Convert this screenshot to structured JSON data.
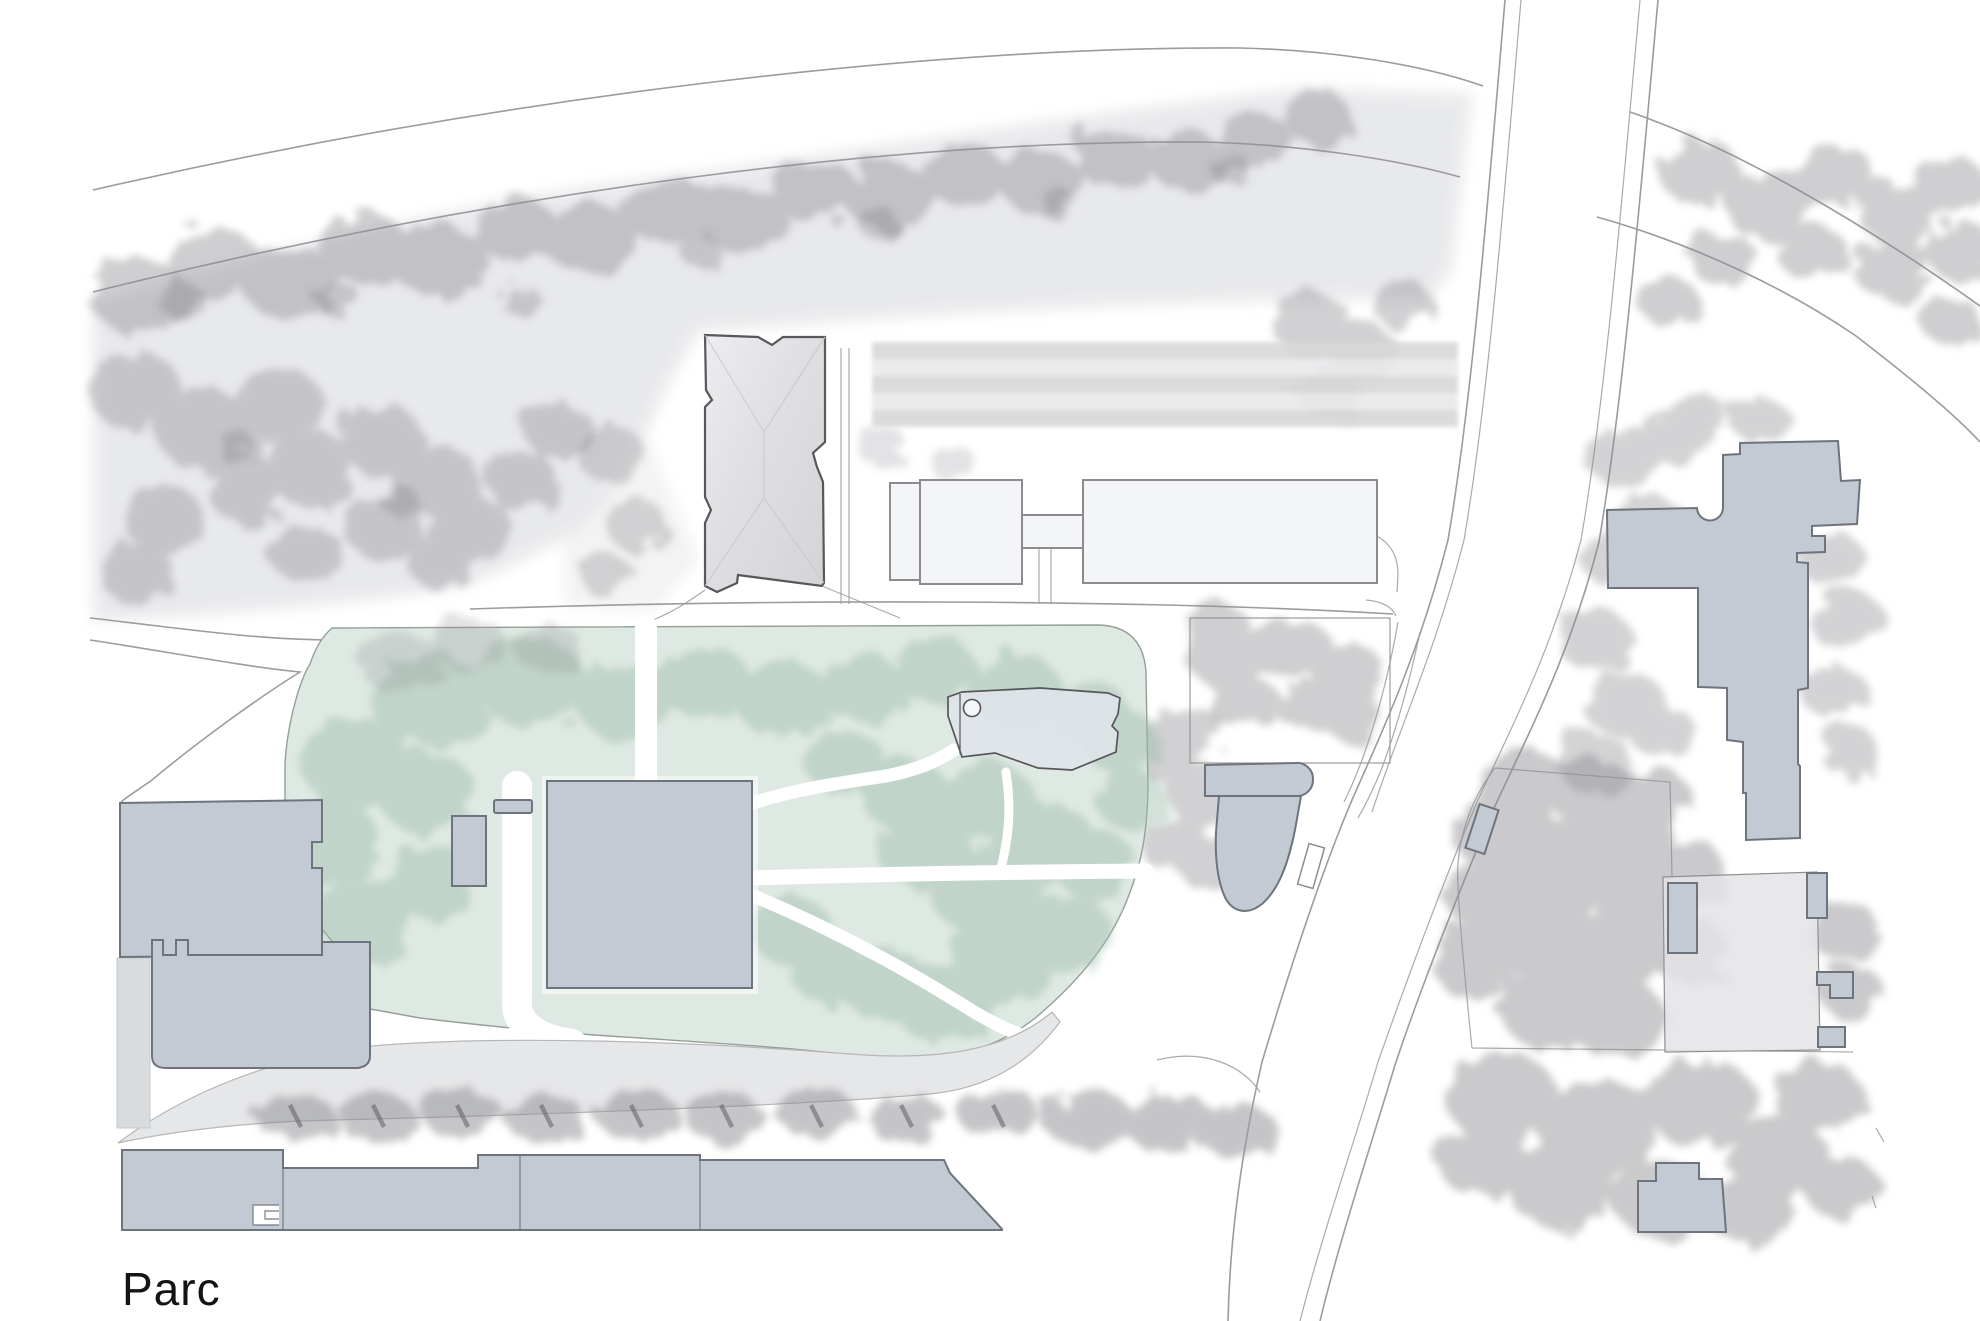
{
  "map": {
    "caption": "Parc",
    "palette": {
      "background": "#ffffff",
      "road": "#9b9ba0",
      "wash": "#e7e8ea",
      "grayTree": "#8c8c91",
      "grayTreeDark": "#74747a",
      "greenWash": "#dfe9e3",
      "greenTree": "#9cbcab",
      "bldgFill": "#c4cad4",
      "bldgStroke": "#6e747e",
      "outFill": "#f4f5f6",
      "outStroke": "#8c8c90",
      "stripeA": "#d7d8d9",
      "stripeB": "#e8e9ea",
      "pondFill": "#dfe4e9",
      "pondStroke": "#55555a",
      "esplanade": "#e6e7e8",
      "esplanadeEdge": "#b5b6b8",
      "captionColor": "#141414"
    }
  }
}
